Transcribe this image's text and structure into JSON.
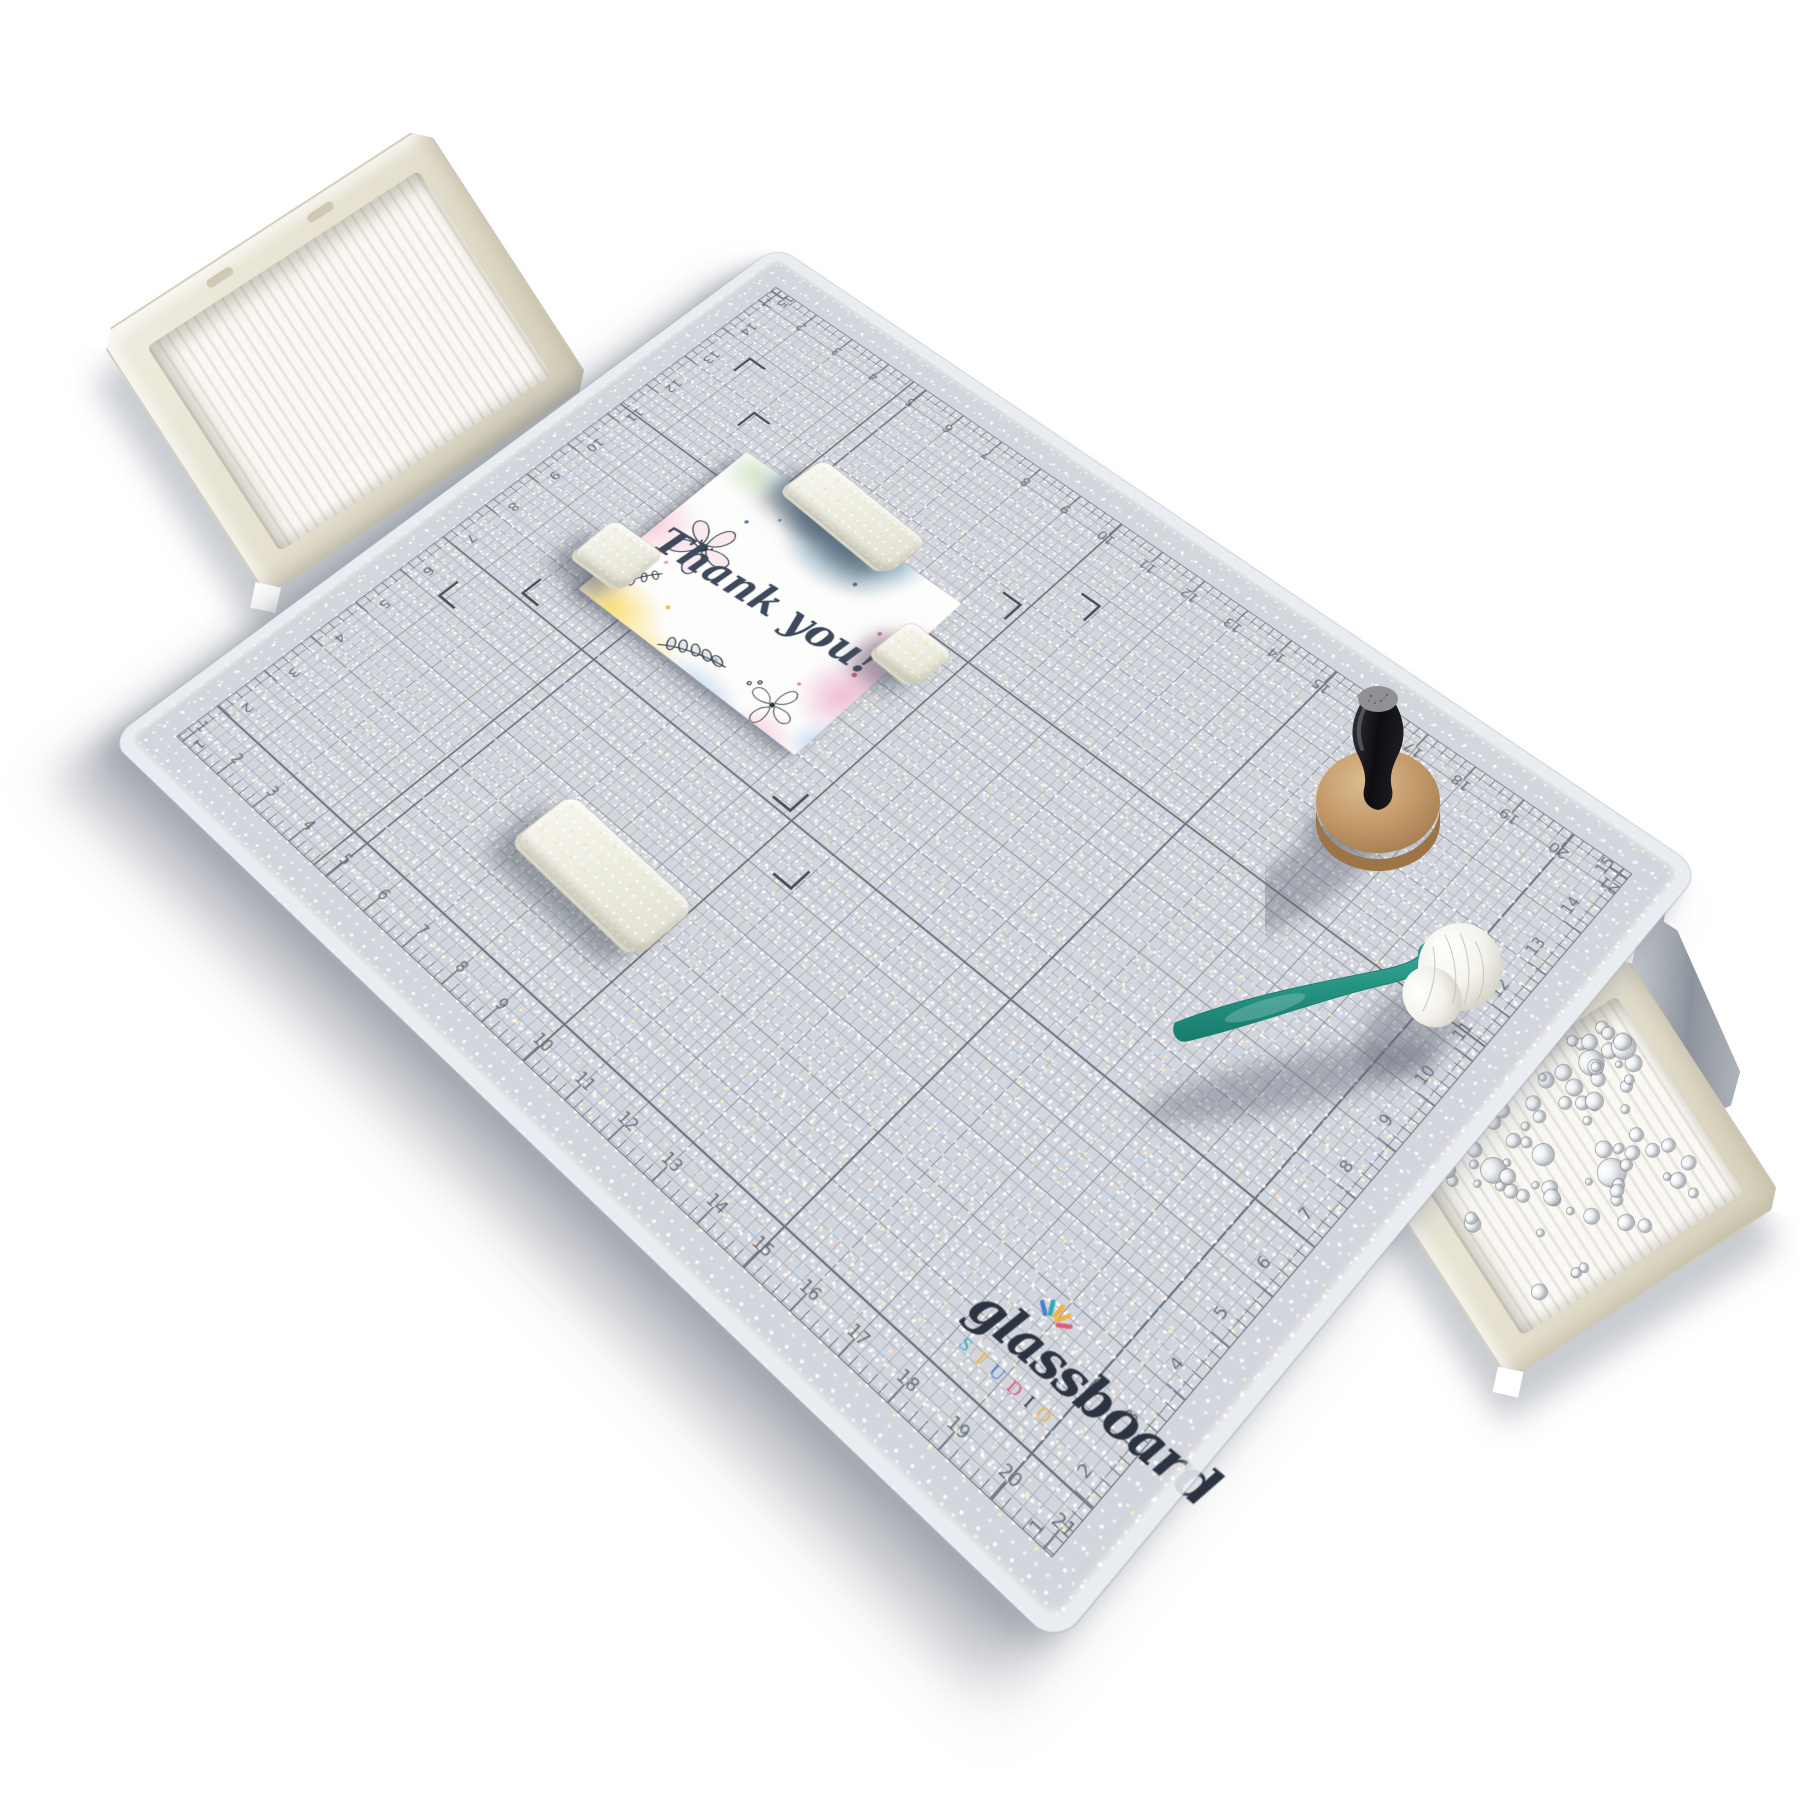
{
  "board": {
    "ruler_long_labels": [
      "1",
      "2",
      "3",
      "4",
      "5",
      "6",
      "7",
      "8",
      "9",
      "10",
      "11",
      "12",
      "13",
      "14",
      "15",
      "16",
      "17",
      "18",
      "19",
      "20",
      "21"
    ],
    "ruler_short_labels": [
      "1",
      "2",
      "3",
      "4",
      "5",
      "6",
      "7",
      "8",
      "9",
      "10",
      "11",
      "12",
      "13",
      "14",
      "15"
    ],
    "logo": {
      "script": "glassboard",
      "sub": "STUDIO",
      "sub_colors": [
        "#3aa8b8",
        "#f2b33d",
        "#4a7fd4",
        "#e05a7a",
        "#2c3442",
        "#f2b33d"
      ],
      "burst_colors": [
        "#4a7fd4",
        "#2fa8b5",
        "#f2b33d",
        "#f2b33d",
        "#e05a7a"
      ]
    }
  },
  "card": {
    "message": "Thank you!"
  },
  "colors": {
    "surface": "#d3d6dc",
    "grid_minor": "#b3b7bf",
    "grid_inch": "#8f949d",
    "grid_major": "#6f747e",
    "grid_border": "#767b84",
    "tick": "#7b8089",
    "number": "#686d75",
    "bracket": "#4a4f57",
    "logo_script": "#2c3442",
    "card_text": "#3e4a5c",
    "block": "#f0efe4",
    "tray": "#e9e5d7",
    "brush_teal": "#2f9e8d",
    "stamp_wood": "#c49a6a",
    "stamp_handle": "#17171a",
    "metal_flap": "#aeb4bc"
  }
}
